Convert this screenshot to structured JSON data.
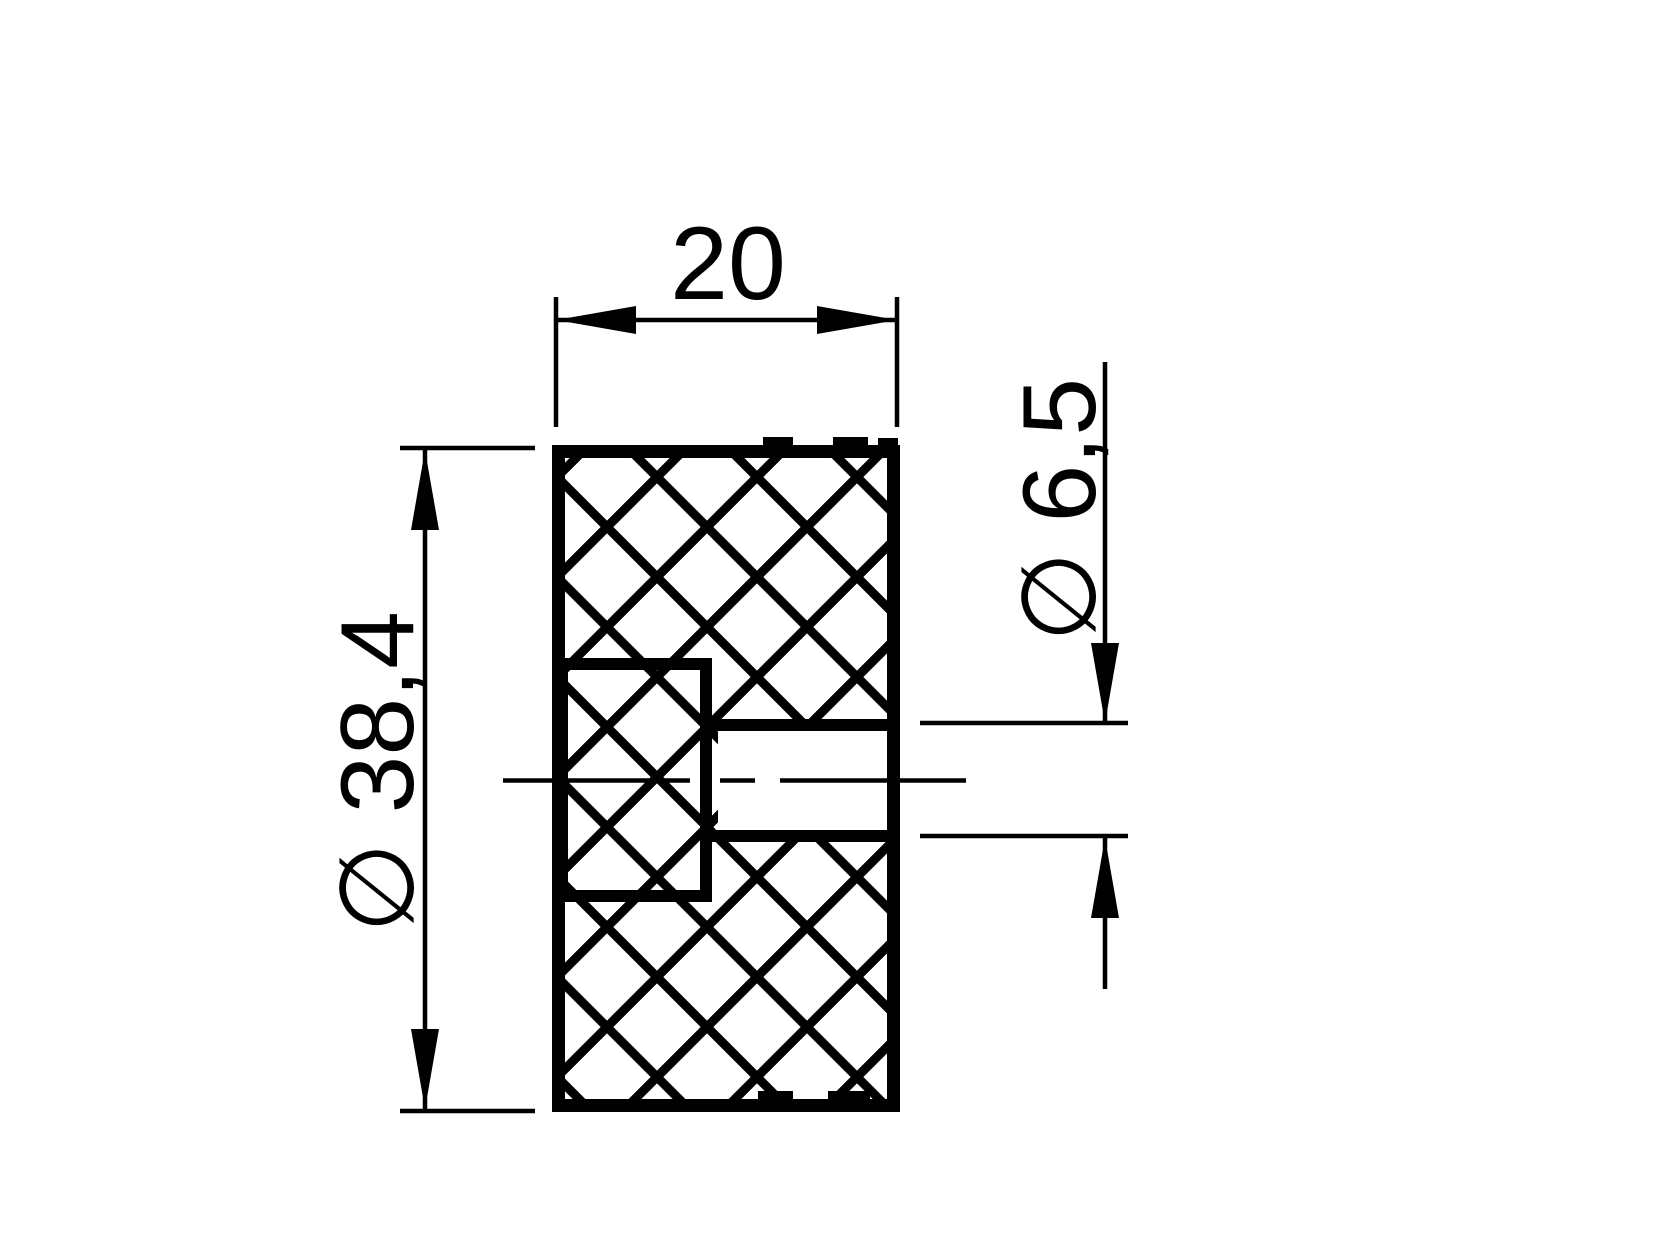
{
  "colors": {
    "background": "#ffffff",
    "ink": "#000000"
  },
  "dimensions": {
    "width": {
      "label": "20"
    },
    "outer_diameter": {
      "label": "∅ 38,4"
    },
    "bore_diameter": {
      "label": "∅ 6,5"
    }
  }
}
